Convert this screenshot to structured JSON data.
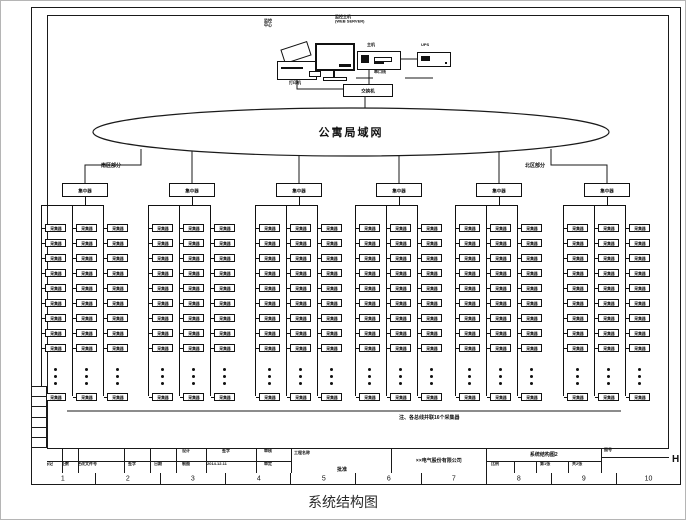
{
  "page": {
    "caption": "系统结构图",
    "row_letter": "H"
  },
  "top_cluster": {
    "console_label_1": "监控",
    "console_label_2": "中心",
    "server_label_1": "监控主机",
    "server_label_2": "(WEB SERVER)",
    "printer_label": "打印机",
    "host_label": "主机",
    "ups_label": "UPS",
    "switch_label": "交换机",
    "serial_label": "串口线"
  },
  "network": {
    "lan_label": "公寓局域网",
    "south_label": "南区部分",
    "north_label": "北区部分",
    "note": "注、各总线并联16个采集器"
  },
  "tree": {
    "hub_label": "集中器",
    "device_label": "采集器",
    "hub_count": 6,
    "columns_per_hub": 3,
    "boxes_per_column": 9,
    "tail_boxes_per_column": 1
  },
  "title_block": {
    "rev_labels": [
      "标记",
      "处数",
      "更改文件号",
      "签字",
      "日期"
    ],
    "sign_rows": [
      [
        "设计",
        "签字",
        "审核"
      ],
      [
        "制图",
        "2014.12.11",
        "审定"
      ]
    ],
    "project_label": "工程名称",
    "approve_label": "批准",
    "company": "××电气股份有限公司",
    "drawing_title": "系统结构图2",
    "fig_no_label": "图号",
    "scale_label": "比例",
    "sheet_label": "第1张",
    "of_label": "共2张",
    "border_numbers": [
      "1",
      "2",
      "3",
      "4",
      "5",
      "6",
      "7",
      "8",
      "9",
      "10"
    ]
  }
}
